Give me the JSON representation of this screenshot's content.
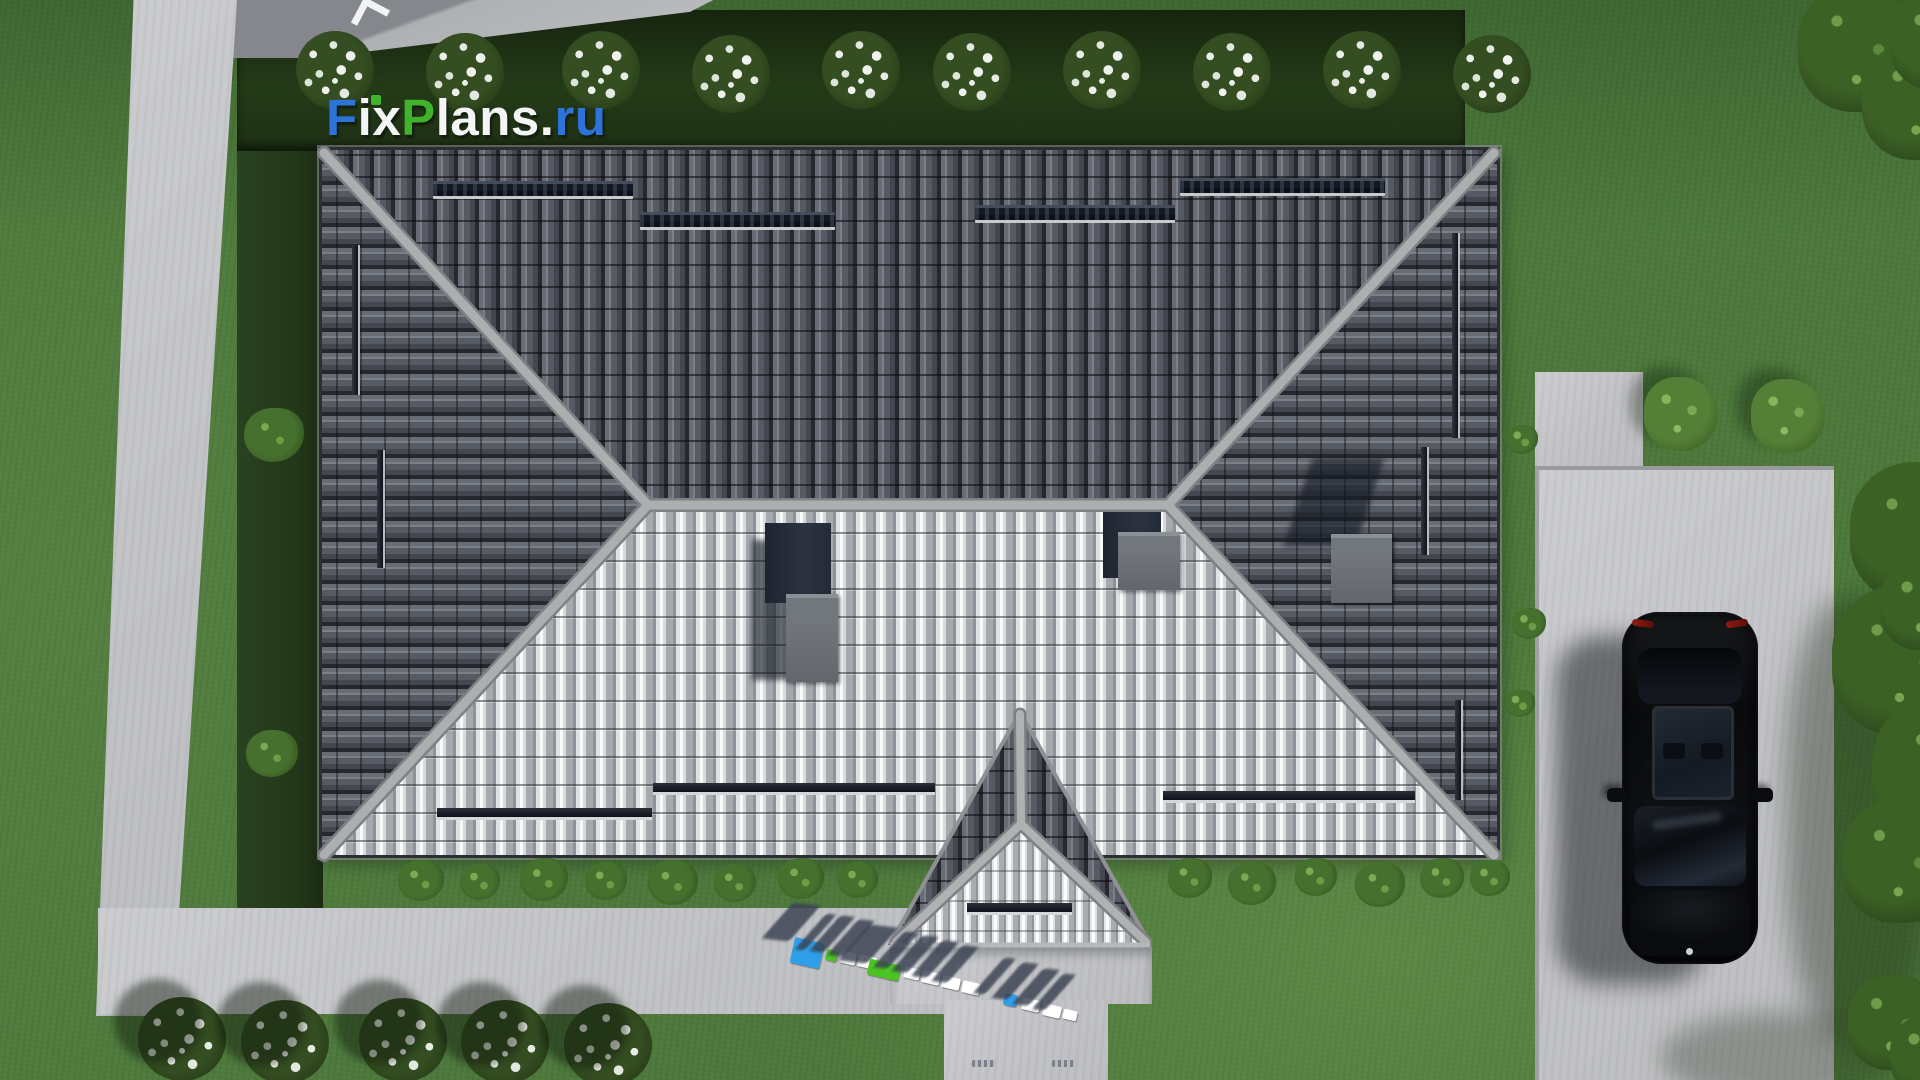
{
  "watermark_logo": {
    "text": "FixPlans.ru",
    "segments": {
      "f": "F",
      "ix": "ix",
      "p": "P",
      "lans": "lans",
      "dot": ".",
      "ru": "ru"
    },
    "colors": {
      "blue": "#2e73d9",
      "green": "#3fb32a",
      "white": "#f4f5f6"
    }
  },
  "ground_sign": {
    "text": "FixPlans.ru",
    "style": "3d-standing-letters-on-walkway",
    "colors": [
      "#2e9fe8",
      "#4bc421",
      "#ffffff"
    ]
  },
  "scene": {
    "view": "top-down aerial 3d architectural render",
    "house": {
      "roof_type": "hip",
      "dark_tile_color": "#53575f",
      "sunlit_tile_color": "#b6b8bc",
      "ridge_color": "#aaabad",
      "chimney_count": 3,
      "porch_roof": "gable",
      "snow_guards": true
    },
    "vehicle": {
      "type": "car",
      "color": "black",
      "location": "driveway",
      "sunroof": true,
      "taillights": "red"
    },
    "landscape": {
      "lawn_color": "#4d7a3c",
      "hedge_color": "#22351a",
      "concrete_color": "#c6c7c9",
      "flower_bushes_top_row": 10,
      "flower_bushes_bottom_row": 5,
      "round_bushes_by_driveway": 2,
      "trees_right_edge": true,
      "paths": [
        "left walkway",
        "bottom walkway",
        "entrance walkway",
        "driveway"
      ]
    }
  }
}
